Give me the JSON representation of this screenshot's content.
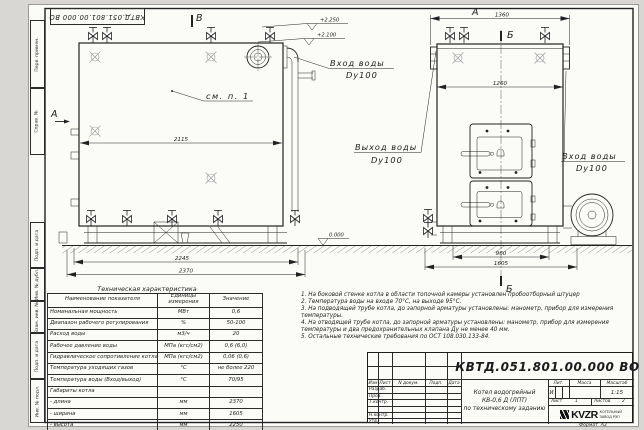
{
  "stamp": {
    "doc_number": "КВТД.051.801.00.000 ВО"
  },
  "margin": {
    "labels": [
      "Перв. примен.",
      "Справ. №",
      "Подп. и дата",
      "Инв. № дубл.",
      "Взам. инв. №",
      "Подп. и дата",
      "Инв. № подл."
    ]
  },
  "drawing": {
    "view_markers": {
      "top": "В",
      "left": "А",
      "front_label": "А",
      "section_top": "Б",
      "section_bottom": "Б"
    },
    "callout": "см. п. 1",
    "labels": {
      "inlet_top": {
        "line1": "Вход воды",
        "line2": "Dy100"
      },
      "outlet": {
        "line1": "Выход воды",
        "line2": "Dy100"
      },
      "inlet_right": {
        "line1": "Вход воды",
        "line2": "Dy100"
      }
    },
    "elevations": {
      "top1": "+2.250",
      "top2": "+2.100",
      "ground": "0.000"
    },
    "dimensions": {
      "side_width": "2115",
      "base_inner": "2245",
      "base_outer": "2370",
      "front_top": "1360",
      "front_body": "1260",
      "front_base_inner": "960",
      "front_base_outer": "1605"
    }
  },
  "tech_table": {
    "title": "Техническая характеристика",
    "headers": [
      "Наименование показателя",
      "Единицы измерения",
      "Значение"
    ],
    "rows": [
      [
        "Номинальная мощность",
        "МВт",
        "0,6"
      ],
      [
        "Диапазон рабочего регулирования",
        "%",
        "50-100"
      ],
      [
        "Расход воды",
        "м3/ч",
        "20"
      ],
      [
        "Рабочее давление воды",
        "МПа (кгс/см2)",
        "0,6 (6,0)"
      ],
      [
        "Гидравлическое сопротивление котла",
        "МПа (кгс/см2)",
        "0,06 (0,6)"
      ],
      [
        "Температура уходящих газов",
        "°С",
        "не более 220"
      ],
      [
        "Температура воды (Вход/выход)",
        "°С",
        "70/95"
      ],
      [
        "Габариты котла",
        "",
        ""
      ],
      [
        "- длина",
        "мм",
        "2370"
      ],
      [
        "- ширина",
        "мм",
        "1605"
      ],
      [
        "- высота",
        "мм",
        "2250"
      ]
    ]
  },
  "notes": [
    "1. На боковой стенке котла в области топочной камеры установлен пробоотборный штуцер",
    "2. Температура воды на входе 70°С, на выходе 95°С.",
    "3. На подводящей трубе котла, до запорной арматуры установлены: манометр, прибор для измерения температуры.",
    "4. На отводящей трубе котла, до запорной арматуры установлены: манометр, прибор для измерения температуры и два предохранительных клапана Ду не менее 40 мм.",
    "5. Остальные технические требования по ОСТ 108.030.133-84."
  ],
  "title_block": {
    "doc_number": "КВТД.051.801.00.000 ВО",
    "columns": [
      "Изм",
      "Лист",
      "N докум.",
      "Подп.",
      "Дата"
    ],
    "row_labels": [
      "Разраб.",
      "Пров.",
      "Т.контр.",
      "",
      "Н.контр.",
      "Утв."
    ],
    "product_title_1": "Котел водогрейный",
    "product_title_2": "КВ-0,6 Д (ЛПТ)",
    "product_title_3": "по техническому заданию",
    "lit_header": "Лит.",
    "mass_header": "Масса",
    "scale_header": "Масштаб",
    "lit_value": "И",
    "scale_value": "1:15",
    "sheet_label": "Лист",
    "sheet_value": "1",
    "sheets_label": "Листов",
    "sheets_value": "2",
    "logo_text": "KVZR",
    "logo_sub1": "КОТЕЛЬНЫЙ",
    "logo_sub2": "ЗАВОД РЭП",
    "format_label": "Формат",
    "format_value": "А3"
  }
}
